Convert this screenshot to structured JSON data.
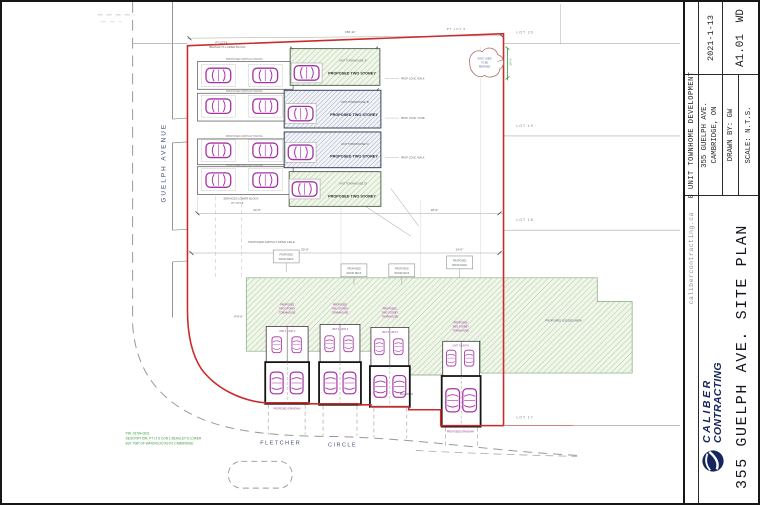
{
  "titleblock": {
    "project_type": "8 UNIT TOWNHOME DEVELOPMENT",
    "website": "calibercontracting.ca",
    "address1": "355 GUELPH AVE.",
    "address2": "CAMBRIDGE, ON",
    "drawn_by": "DRAWN BY: GW",
    "scale": "SCALE: N.T.S.",
    "date": "2021-1-13",
    "sheet_no": "A1.01",
    "sheet_rev": "WD",
    "logo_top": "CALIBER",
    "logo_bottom": "CONTRACTING",
    "sheet_title": "355 GUELPH AVE. SITE PLAN"
  },
  "drawing": {
    "streets": {
      "guelph": "GUELPH  AVENUE",
      "fletcher": "FLETCHER",
      "circle": "CIRCLE"
    },
    "lots": {
      "r1": "LOT 20",
      "r2": "LOT 19",
      "r3": "LOT 18",
      "r4": "LOT 17",
      "top": "PT LOT 9",
      "parcel": "PT LOT 8",
      "beasley": "BEASLEY'S LOWER BLOCK",
      "block": "BLOCK 10"
    },
    "notes": {
      "line1": "PIN: 03784-0021",
      "line2": "DESCRIPTION: PT LT 8 CON 1 BEASLEY'S LOWER",
      "line3": "BLK TWP OF WATERLOO AS IN; CAMBRIDGE"
    },
    "labels": {
      "asphalt": "PROPOSED ASPHALT PAVING",
      "two_storey": "PROPOSED TWO STOREY",
      "unit_a": "UNIT TOWNHOUSE 'A'",
      "unit_b": "UNIT TOWNHOUSE 'B'",
      "unit_c": "UNIT TOWNHOUSE 'C'",
      "unit_d": "UNIT TOWNHOUSE 'D'",
      "th1": "PROPOSED",
      "th2": "TWO STOREY",
      "th3": "TOWNHOUSE",
      "deck1": "PROPOSED",
      "deck2": "WOOD DECK",
      "driveway": "PROPOSED DRIVEWAY",
      "aisle": "PROPOSED ASPHALT DRIVE AISLE",
      "walk": "PROP. CONC. WALK",
      "curb": "PROP. CONC. CURB",
      "grass": "PROPOSED SODDED AREA",
      "services": "SERVICES LOWER BLOCK",
      "cloud1": "EXIST. SHED",
      "cloud2": "TO BE",
      "cloud3": "REMOVED"
    },
    "units": {
      "p1": "UNIT 1 | UNIT 2",
      "p2": "UNIT 3 | UNIT 4",
      "p3": "UNIT 5 | UNIT 6",
      "p4": "UNIT 7 | UNIT 8"
    },
    "dims": {
      "d1": "150'-11\"",
      "d2": "24'-0\"",
      "d3": "20'-0\"",
      "d4": "29'-6\"",
      "d5": "18'-0\"",
      "d6": "R 9'-0\""
    }
  }
}
